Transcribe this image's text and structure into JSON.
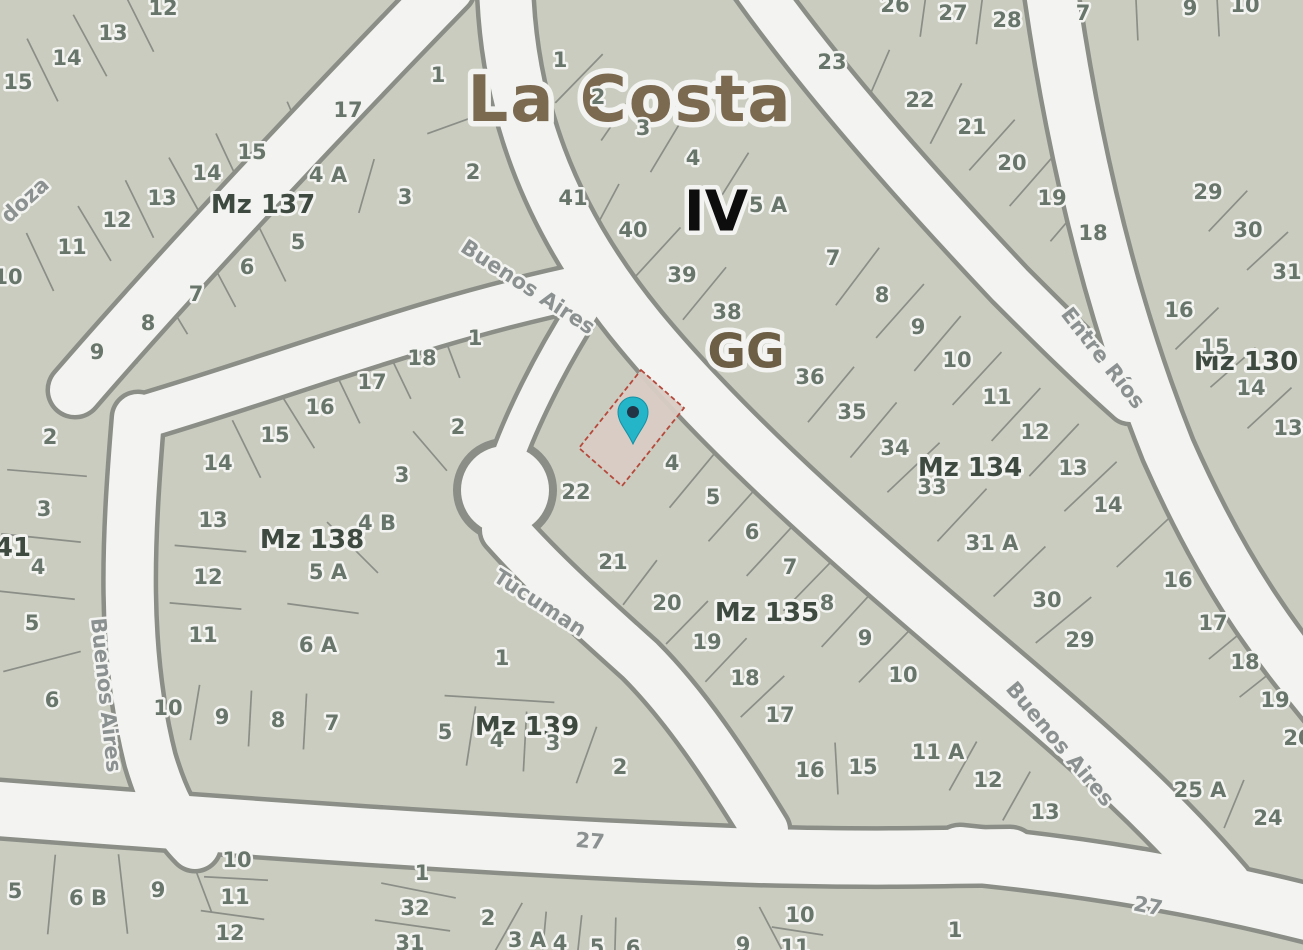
{
  "map": {
    "region_title": "La Costa",
    "section_label": "IV",
    "zone_label": "GG",
    "colors": {
      "parcel_fill": "#c9ccbe",
      "street_fill": "#f3f4f1",
      "line": "#8a8e87",
      "parcel_number": "#68756a",
      "block_label": "#3e4a40",
      "street_label": "#8b9190",
      "title": "#7b6950",
      "section": "#0d0d0d",
      "zone": "#6d5e46",
      "pin": "#25b5c9",
      "pin_core": "#243447",
      "highlight_fill": "#d8ccc4",
      "highlight_stroke": "#b5493c"
    },
    "marker": {
      "x": 633,
      "y": 414,
      "tip_y": 444
    },
    "highlight_parcel": {
      "points": "641,370 684,408 622,486 579,448"
    },
    "block_names": [
      "Mz 137",
      "Mz 138",
      "Mz 139",
      "Mz 135",
      "Mz 134",
      "Mz 130",
      "41"
    ],
    "street_names": [
      "Buenos Aires",
      "Entre Ríos",
      "Tucuman",
      "doza",
      "27"
    ]
  },
  "labels": [
    {
      "id": "LA",
      "t": "La Costa",
      "x": 630,
      "y": 100,
      "k": "t"
    },
    {
      "id": "IV",
      "t": "IV",
      "x": 716,
      "y": 212,
      "k": "iv"
    },
    {
      "id": "GG",
      "t": "GG",
      "x": 746,
      "y": 352,
      "k": "gg"
    },
    {
      "id": "sdoza",
      "t": "doza",
      "x": 25,
      "y": 200,
      "k": "st",
      "r": -42
    },
    {
      "id": "sba1",
      "t": "Buenos Aires",
      "x": 528,
      "y": 287,
      "k": "st",
      "r": 33
    },
    {
      "id": "ser",
      "t": "Entre Ríos",
      "x": 1103,
      "y": 358,
      "k": "st",
      "r": 52
    },
    {
      "id": "stuc",
      "t": "Tucuman",
      "x": 540,
      "y": 603,
      "k": "st",
      "r": 33
    },
    {
      "id": "sba2",
      "t": "Buenos Aires",
      "x": 106,
      "y": 695,
      "k": "st",
      "r": 84
    },
    {
      "id": "sba3",
      "t": "Buenos Aires",
      "x": 1060,
      "y": 744,
      "k": "st",
      "r": 50
    },
    {
      "id": "s27a",
      "t": "27",
      "x": 590,
      "y": 841,
      "k": "st",
      "r": 5
    },
    {
      "id": "s27b",
      "t": "27",
      "x": 1148,
      "y": 906,
      "k": "st",
      "r": 11
    },
    {
      "id": "bMZ",
      "t": "Mz 137",
      "x": 263,
      "y": 205,
      "k": "mz"
    },
    {
      "id": "mMZ",
      "t": "Mz 138",
      "x": 312,
      "y": 540,
      "k": "mz"
    },
    {
      "id": "kMZ",
      "t": "Mz 139",
      "x": 527,
      "y": 727,
      "k": "mz"
    },
    {
      "id": "pMZ",
      "t": "Mz 135",
      "x": 767,
      "y": 613,
      "k": "mz"
    },
    {
      "id": "gMZ",
      "t": "Mz 134",
      "x": 970,
      "y": 468,
      "k": "mz"
    },
    {
      "id": "rMZ",
      "t": "Mz 130",
      "x": 1246,
      "y": 362,
      "k": "mz"
    },
    {
      "id": "w41",
      "t": "41",
      "x": 13,
      "y": 548,
      "k": "mz"
    },
    {
      "id": "a12",
      "t": "12",
      "x": 163,
      "y": 8,
      "k": "p"
    },
    {
      "id": "a13",
      "t": "13",
      "x": 113,
      "y": 33,
      "k": "p"
    },
    {
      "id": "a14",
      "t": "14",
      "x": 67,
      "y": 58,
      "k": "p"
    },
    {
      "id": "a15",
      "t": "15",
      "x": 18,
      "y": 82,
      "k": "p"
    },
    {
      "id": "b1",
      "t": "1",
      "x": 438,
      "y": 75,
      "k": "p"
    },
    {
      "id": "b2",
      "t": "2",
      "x": 473,
      "y": 172,
      "k": "p"
    },
    {
      "id": "b17",
      "t": "17",
      "x": 348,
      "y": 110,
      "k": "p"
    },
    {
      "id": "b15",
      "t": "15",
      "x": 252,
      "y": 152,
      "k": "p"
    },
    {
      "id": "b14",
      "t": "14",
      "x": 207,
      "y": 173,
      "k": "p"
    },
    {
      "id": "b4A",
      "t": "4 A",
      "x": 328,
      "y": 175,
      "k": "p"
    },
    {
      "id": "b3",
      "t": "3",
      "x": 405,
      "y": 197,
      "k": "p"
    },
    {
      "id": "b13",
      "t": "13",
      "x": 162,
      "y": 198,
      "k": "p"
    },
    {
      "id": "b12",
      "t": "12",
      "x": 117,
      "y": 220,
      "k": "p"
    },
    {
      "id": "b5",
      "t": "5",
      "x": 298,
      "y": 242,
      "k": "p"
    },
    {
      "id": "b11",
      "t": "11",
      "x": 72,
      "y": 247,
      "k": "p"
    },
    {
      "id": "b6",
      "t": "6",
      "x": 247,
      "y": 267,
      "k": "p"
    },
    {
      "id": "b10",
      "t": "10",
      "x": 8,
      "y": 277,
      "k": "p"
    },
    {
      "id": "b7",
      "t": "7",
      "x": 196,
      "y": 294,
      "k": "p"
    },
    {
      "id": "b8",
      "t": "8",
      "x": 148,
      "y": 323,
      "k": "p"
    },
    {
      "id": "b9",
      "t": "9",
      "x": 97,
      "y": 352,
      "k": "p"
    },
    {
      "id": "t1",
      "t": "1",
      "x": 560,
      "y": 60,
      "k": "p"
    },
    {
      "id": "t2",
      "t": "2",
      "x": 598,
      "y": 97,
      "k": "p"
    },
    {
      "id": "t3",
      "t": "3",
      "x": 643,
      "y": 128,
      "k": "p"
    },
    {
      "id": "t4",
      "t": "4",
      "x": 693,
      "y": 158,
      "k": "p"
    },
    {
      "id": "t41",
      "t": "41",
      "x": 573,
      "y": 198,
      "k": "p"
    },
    {
      "id": "t5A",
      "t": "5 A",
      "x": 768,
      "y": 205,
      "k": "p"
    },
    {
      "id": "t40",
      "t": "40",
      "x": 633,
      "y": 230,
      "k": "p"
    },
    {
      "id": "t39",
      "t": "39",
      "x": 682,
      "y": 275,
      "k": "p"
    },
    {
      "id": "t38",
      "t": "38",
      "x": 727,
      "y": 312,
      "k": "p"
    },
    {
      "id": "g7",
      "t": "7",
      "x": 833,
      "y": 258,
      "k": "p"
    },
    {
      "id": "g8",
      "t": "8",
      "x": 882,
      "y": 295,
      "k": "p"
    },
    {
      "id": "g9",
      "t": "9",
      "x": 918,
      "y": 327,
      "k": "p"
    },
    {
      "id": "g10",
      "t": "10",
      "x": 957,
      "y": 360,
      "k": "p"
    },
    {
      "id": "g11",
      "t": "11",
      "x": 997,
      "y": 397,
      "k": "p"
    },
    {
      "id": "g12",
      "t": "12",
      "x": 1035,
      "y": 432,
      "k": "p"
    },
    {
      "id": "g13",
      "t": "13",
      "x": 1073,
      "y": 468,
      "k": "p"
    },
    {
      "id": "g14",
      "t": "14",
      "x": 1108,
      "y": 505,
      "k": "p"
    },
    {
      "id": "g16",
      "t": "16",
      "x": 1178,
      "y": 580,
      "k": "p"
    },
    {
      "id": "g36",
      "t": "36",
      "x": 810,
      "y": 377,
      "k": "p"
    },
    {
      "id": "g35",
      "t": "35",
      "x": 852,
      "y": 412,
      "k": "p"
    },
    {
      "id": "g34",
      "t": "34",
      "x": 895,
      "y": 448,
      "k": "p"
    },
    {
      "id": "g33",
      "t": "33",
      "x": 932,
      "y": 487,
      "k": "p"
    },
    {
      "id": "g31A",
      "t": "31 A",
      "x": 992,
      "y": 543,
      "k": "p"
    },
    {
      "id": "g30",
      "t": "30",
      "x": 1047,
      "y": 600,
      "k": "p"
    },
    {
      "id": "g29",
      "t": "29",
      "x": 1080,
      "y": 640,
      "k": "p"
    },
    {
      "id": "u23",
      "t": "23",
      "x": 832,
      "y": 62,
      "k": "p"
    },
    {
      "id": "u26",
      "t": "26",
      "x": 895,
      "y": 5,
      "k": "p"
    },
    {
      "id": "u27",
      "t": "27",
      "x": 953,
      "y": 13,
      "k": "p"
    },
    {
      "id": "u28",
      "t": "28",
      "x": 1007,
      "y": 20,
      "k": "p"
    },
    {
      "id": "u22",
      "t": "22",
      "x": 920,
      "y": 100,
      "k": "p"
    },
    {
      "id": "u21",
      "t": "21",
      "x": 972,
      "y": 127,
      "k": "p"
    },
    {
      "id": "u20",
      "t": "20",
      "x": 1012,
      "y": 163,
      "k": "p"
    },
    {
      "id": "u19",
      "t": "19",
      "x": 1052,
      "y": 198,
      "k": "p"
    },
    {
      "id": "u18",
      "t": "18",
      "x": 1093,
      "y": 233,
      "k": "p"
    },
    {
      "id": "n7",
      "t": "7",
      "x": 1083,
      "y": 13,
      "k": "p"
    },
    {
      "id": "n9",
      "t": "9",
      "x": 1190,
      "y": 8,
      "k": "p"
    },
    {
      "id": "n10",
      "t": "10",
      "x": 1245,
      "y": 5,
      "k": "p"
    },
    {
      "id": "r29",
      "t": "29",
      "x": 1208,
      "y": 192,
      "k": "p"
    },
    {
      "id": "r30",
      "t": "30",
      "x": 1248,
      "y": 230,
      "k": "p"
    },
    {
      "id": "r31",
      "t": "31",
      "x": 1287,
      "y": 272,
      "k": "p"
    },
    {
      "id": "r16",
      "t": "16",
      "x": 1179,
      "y": 310,
      "k": "p"
    },
    {
      "id": "r15",
      "t": "15",
      "x": 1215,
      "y": 347,
      "k": "p"
    },
    {
      "id": "r14",
      "t": "14",
      "x": 1251,
      "y": 388,
      "k": "p"
    },
    {
      "id": "r13",
      "t": "13",
      "x": 1288,
      "y": 428,
      "k": "p"
    },
    {
      "id": "x17",
      "t": "17",
      "x": 1213,
      "y": 623,
      "k": "p"
    },
    {
      "id": "x18",
      "t": "18",
      "x": 1245,
      "y": 662,
      "k": "p"
    },
    {
      "id": "x19",
      "t": "19",
      "x": 1275,
      "y": 700,
      "k": "p"
    },
    {
      "id": "x20",
      "t": "20",
      "x": 1298,
      "y": 738,
      "k": "p"
    },
    {
      "id": "x25A",
      "t": "25 A",
      "x": 1200,
      "y": 790,
      "k": "p"
    },
    {
      "id": "x24",
      "t": "24",
      "x": 1268,
      "y": 818,
      "k": "p"
    },
    {
      "id": "m1",
      "t": "1",
      "x": 475,
      "y": 338,
      "k": "p"
    },
    {
      "id": "m18",
      "t": "18",
      "x": 422,
      "y": 358,
      "k": "p"
    },
    {
      "id": "m17",
      "t": "17",
      "x": 372,
      "y": 382,
      "k": "p"
    },
    {
      "id": "m16",
      "t": "16",
      "x": 320,
      "y": 407,
      "k": "p"
    },
    {
      "id": "m2",
      "t": "2",
      "x": 458,
      "y": 427,
      "k": "p"
    },
    {
      "id": "m15",
      "t": "15",
      "x": 275,
      "y": 435,
      "k": "p"
    },
    {
      "id": "m14",
      "t": "14",
      "x": 218,
      "y": 463,
      "k": "p"
    },
    {
      "id": "m3",
      "t": "3",
      "x": 402,
      "y": 475,
      "k": "p"
    },
    {
      "id": "m13",
      "t": "13",
      "x": 213,
      "y": 520,
      "k": "p"
    },
    {
      "id": "m4B",
      "t": "4 B",
      "x": 377,
      "y": 523,
      "k": "p"
    },
    {
      "id": "m12",
      "t": "12",
      "x": 208,
      "y": 577,
      "k": "p"
    },
    {
      "id": "m5A",
      "t": "5 A",
      "x": 328,
      "y": 572,
      "k": "p"
    },
    {
      "id": "m11",
      "t": "11",
      "x": 203,
      "y": 635,
      "k": "p"
    },
    {
      "id": "m6A",
      "t": "6 A",
      "x": 318,
      "y": 645,
      "k": "p"
    },
    {
      "id": "m10",
      "t": "10",
      "x": 168,
      "y": 708,
      "k": "p"
    },
    {
      "id": "m9",
      "t": "9",
      "x": 222,
      "y": 717,
      "k": "p"
    },
    {
      "id": "m8",
      "t": "8",
      "x": 278,
      "y": 720,
      "k": "p"
    },
    {
      "id": "m7",
      "t": "7",
      "x": 332,
      "y": 723,
      "k": "p"
    },
    {
      "id": "w2",
      "t": "2",
      "x": 50,
      "y": 437,
      "k": "p"
    },
    {
      "id": "w3",
      "t": "3",
      "x": 44,
      "y": 509,
      "k": "p"
    },
    {
      "id": "w4",
      "t": "4",
      "x": 38,
      "y": 567,
      "k": "p"
    },
    {
      "id": "w5",
      "t": "5",
      "x": 32,
      "y": 623,
      "k": "p"
    },
    {
      "id": "w6",
      "t": "6",
      "x": 52,
      "y": 700,
      "k": "p"
    },
    {
      "id": "k1",
      "t": "1",
      "x": 502,
      "y": 658,
      "k": "p"
    },
    {
      "id": "k5",
      "t": "5",
      "x": 445,
      "y": 732,
      "k": "p"
    },
    {
      "id": "k4",
      "t": "4",
      "x": 497,
      "y": 740,
      "k": "p"
    },
    {
      "id": "k3",
      "t": "3",
      "x": 553,
      "y": 743,
      "k": "p"
    },
    {
      "id": "k2",
      "t": "2",
      "x": 620,
      "y": 767,
      "k": "p"
    },
    {
      "id": "p4",
      "t": "4",
      "x": 672,
      "y": 463,
      "k": "p"
    },
    {
      "id": "p5",
      "t": "5",
      "x": 713,
      "y": 497,
      "k": "p"
    },
    {
      "id": "p6",
      "t": "6",
      "x": 752,
      "y": 532,
      "k": "p"
    },
    {
      "id": "p7",
      "t": "7",
      "x": 790,
      "y": 567,
      "k": "p"
    },
    {
      "id": "p8",
      "t": "8",
      "x": 827,
      "y": 603,
      "k": "p"
    },
    {
      "id": "p9",
      "t": "9",
      "x": 865,
      "y": 638,
      "k": "p"
    },
    {
      "id": "p10",
      "t": "10",
      "x": 903,
      "y": 675,
      "k": "p"
    },
    {
      "id": "q20",
      "t": "20",
      "x": 667,
      "y": 603,
      "k": "p"
    },
    {
      "id": "q19",
      "t": "19",
      "x": 707,
      "y": 642,
      "k": "p"
    },
    {
      "id": "q18",
      "t": "18",
      "x": 745,
      "y": 678,
      "k": "p"
    },
    {
      "id": "q17",
      "t": "17",
      "x": 780,
      "y": 715,
      "k": "p"
    },
    {
      "id": "s22",
      "t": "22",
      "x": 576,
      "y": 492,
      "k": "p"
    },
    {
      "id": "s21",
      "t": "21",
      "x": 613,
      "y": 562,
      "k": "p"
    },
    {
      "id": "s16",
      "t": "16",
      "x": 810,
      "y": 770,
      "k": "p"
    },
    {
      "id": "s15",
      "t": "15",
      "x": 863,
      "y": 767,
      "k": "p"
    },
    {
      "id": "v11A",
      "t": "11 A",
      "x": 938,
      "y": 752,
      "k": "p"
    },
    {
      "id": "v12",
      "t": "12",
      "x": 988,
      "y": 780,
      "k": "p"
    },
    {
      "id": "v13",
      "t": "13",
      "x": 1045,
      "y": 812,
      "k": "p"
    },
    {
      "id": "d10",
      "t": "10",
      "x": 237,
      "y": 860,
      "k": "p"
    },
    {
      "id": "d11",
      "t": "11",
      "x": 235,
      "y": 897,
      "k": "p"
    },
    {
      "id": "d12",
      "t": "12",
      "x": 230,
      "y": 933,
      "k": "p"
    },
    {
      "id": "d9",
      "t": "9",
      "x": 158,
      "y": 890,
      "k": "p"
    },
    {
      "id": "d6B",
      "t": "6 B",
      "x": 88,
      "y": 898,
      "k": "p"
    },
    {
      "id": "d5",
      "t": "5",
      "x": 15,
      "y": 891,
      "k": "p"
    },
    {
      "id": "c1",
      "t": "1",
      "x": 422,
      "y": 873,
      "k": "p"
    },
    {
      "id": "c32",
      "t": "32",
      "x": 415,
      "y": 908,
      "k": "p"
    },
    {
      "id": "c31",
      "t": "31",
      "x": 410,
      "y": 943,
      "k": "p"
    },
    {
      "id": "c2",
      "t": "2",
      "x": 488,
      "y": 918,
      "k": "p"
    },
    {
      "id": "c3A",
      "t": "3 A",
      "x": 527,
      "y": 940,
      "k": "p"
    },
    {
      "id": "c4",
      "t": "4",
      "x": 560,
      "y": 943,
      "k": "p"
    },
    {
      "id": "c5",
      "t": "5",
      "x": 597,
      "y": 947,
      "k": "p"
    },
    {
      "id": "c6",
      "t": "6",
      "x": 633,
      "y": 948,
      "k": "p"
    },
    {
      "id": "c9",
      "t": "9",
      "x": 743,
      "y": 945,
      "k": "p"
    },
    {
      "id": "c10",
      "t": "10",
      "x": 800,
      "y": 915,
      "k": "p"
    },
    {
      "id": "c11",
      "t": "11",
      "x": 795,
      "y": 947,
      "k": "p"
    },
    {
      "id": "e1",
      "t": "1",
      "x": 955,
      "y": 930,
      "k": "p"
    }
  ]
}
